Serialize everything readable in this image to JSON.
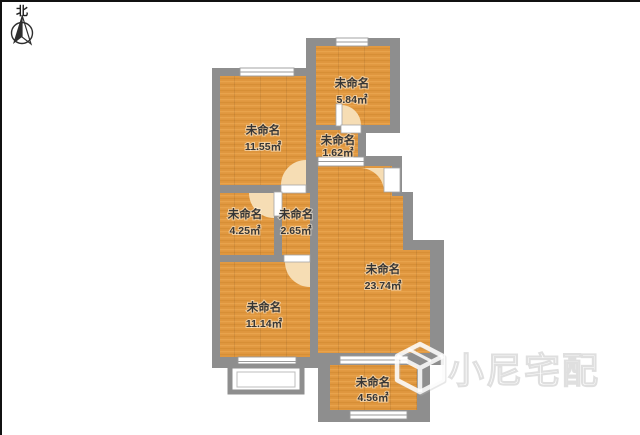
{
  "compass": {
    "label": "北"
  },
  "watermark": {
    "brand": "小尼宅配",
    "icon": "cube-logo-icon"
  },
  "rooms": [
    {
      "id": "room-a",
      "name": "未命名",
      "area": "11.55㎡"
    },
    {
      "id": "room-b",
      "name": "未命名",
      "area": "5.84㎡"
    },
    {
      "id": "room-c",
      "name": "未命名",
      "area": "1.62㎡"
    },
    {
      "id": "room-d",
      "name": "未命名",
      "area": "4.25㎡"
    },
    {
      "id": "room-e",
      "name": "未命名",
      "area": "2.65㎡"
    },
    {
      "id": "room-f",
      "name": "未命名",
      "area": "11.14㎡"
    },
    {
      "id": "room-big",
      "name": "未命名",
      "area": "23.74㎡"
    },
    {
      "id": "room-g",
      "name": "未命名",
      "area": "4.56㎡"
    }
  ],
  "colors": {
    "wall": "#8e8e8e",
    "floor": "#e0973f",
    "floor_dark": "#cf8830",
    "floor_light": "#ebaa52",
    "door_fan": "#f6ddb4",
    "window_fill": "#ffffff",
    "window_frame": "#9a9a9a",
    "border": "#111111",
    "compass_ink": "#2e2e2e"
  }
}
